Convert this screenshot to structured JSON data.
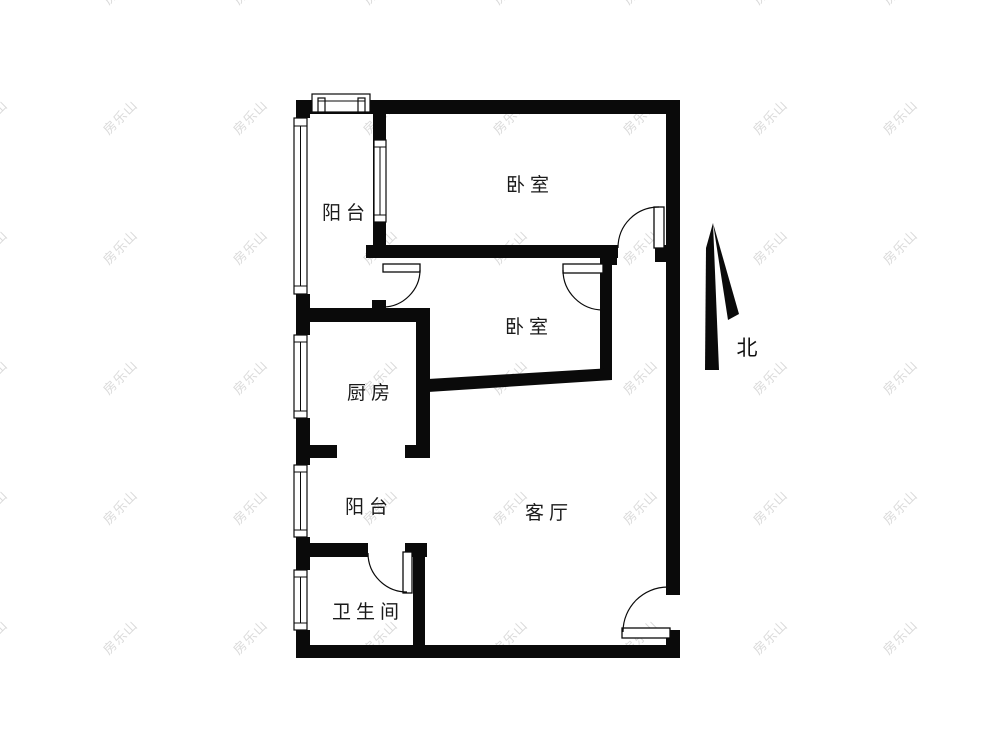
{
  "title": "二室一厅户型图",
  "watermark": {
    "text": "房乐山",
    "color": "#d4d4d4"
  },
  "compass": {
    "label": "北"
  },
  "rooms": {
    "balcony_top": {
      "label": "阳台"
    },
    "bedroom_top": {
      "label": "卧室"
    },
    "bedroom_mid": {
      "label": "卧室"
    },
    "kitchen": {
      "label": "厨房"
    },
    "balcony_mid": {
      "label": "阳台"
    },
    "living_room": {
      "label": "客厅"
    },
    "bathroom": {
      "label": "卫生间"
    }
  },
  "colors": {
    "wall": "#0a0a0a",
    "background": "#ffffff"
  }
}
